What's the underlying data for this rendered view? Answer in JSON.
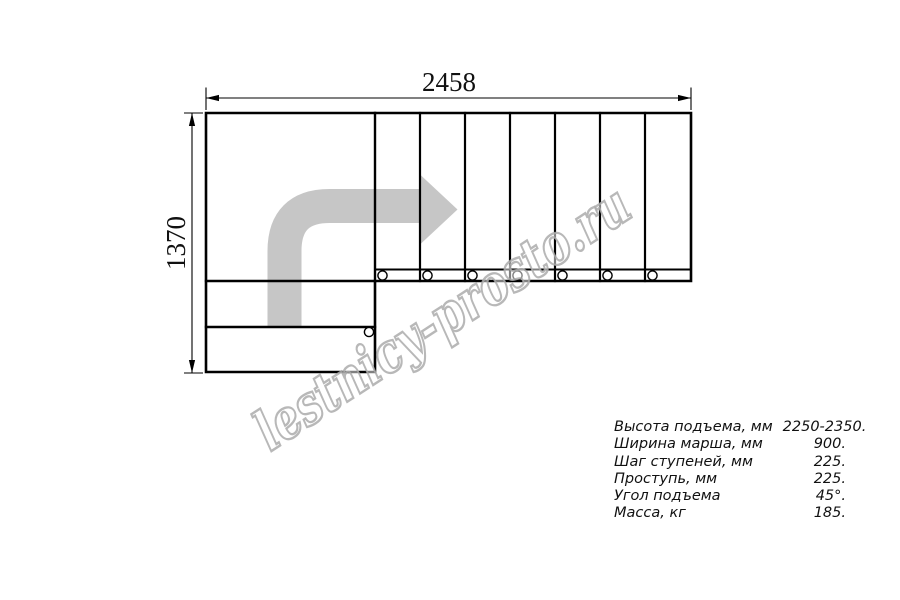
{
  "drawing": {
    "width_dimension": "2458",
    "height_dimension": "1370"
  },
  "watermark": {
    "text": "lestnicy-prosto.ru"
  },
  "specs": {
    "rows": [
      {
        "label": "Высота подъема, мм",
        "value": "2250-2350."
      },
      {
        "label": "Ширина марша, мм",
        "value": "900."
      },
      {
        "label": "Шаг ступеней, мм",
        "value": "225."
      },
      {
        "label": "Проступь, мм",
        "value": "225."
      },
      {
        "label": "Угол подъема",
        "value": "45°."
      },
      {
        "label": "Масса, кг",
        "value": "185."
      }
    ]
  },
  "colors": {
    "line": "#000000",
    "arrow_fill": "#c6c6c6",
    "watermark_stroke": "#ababab",
    "text": "#111111"
  }
}
